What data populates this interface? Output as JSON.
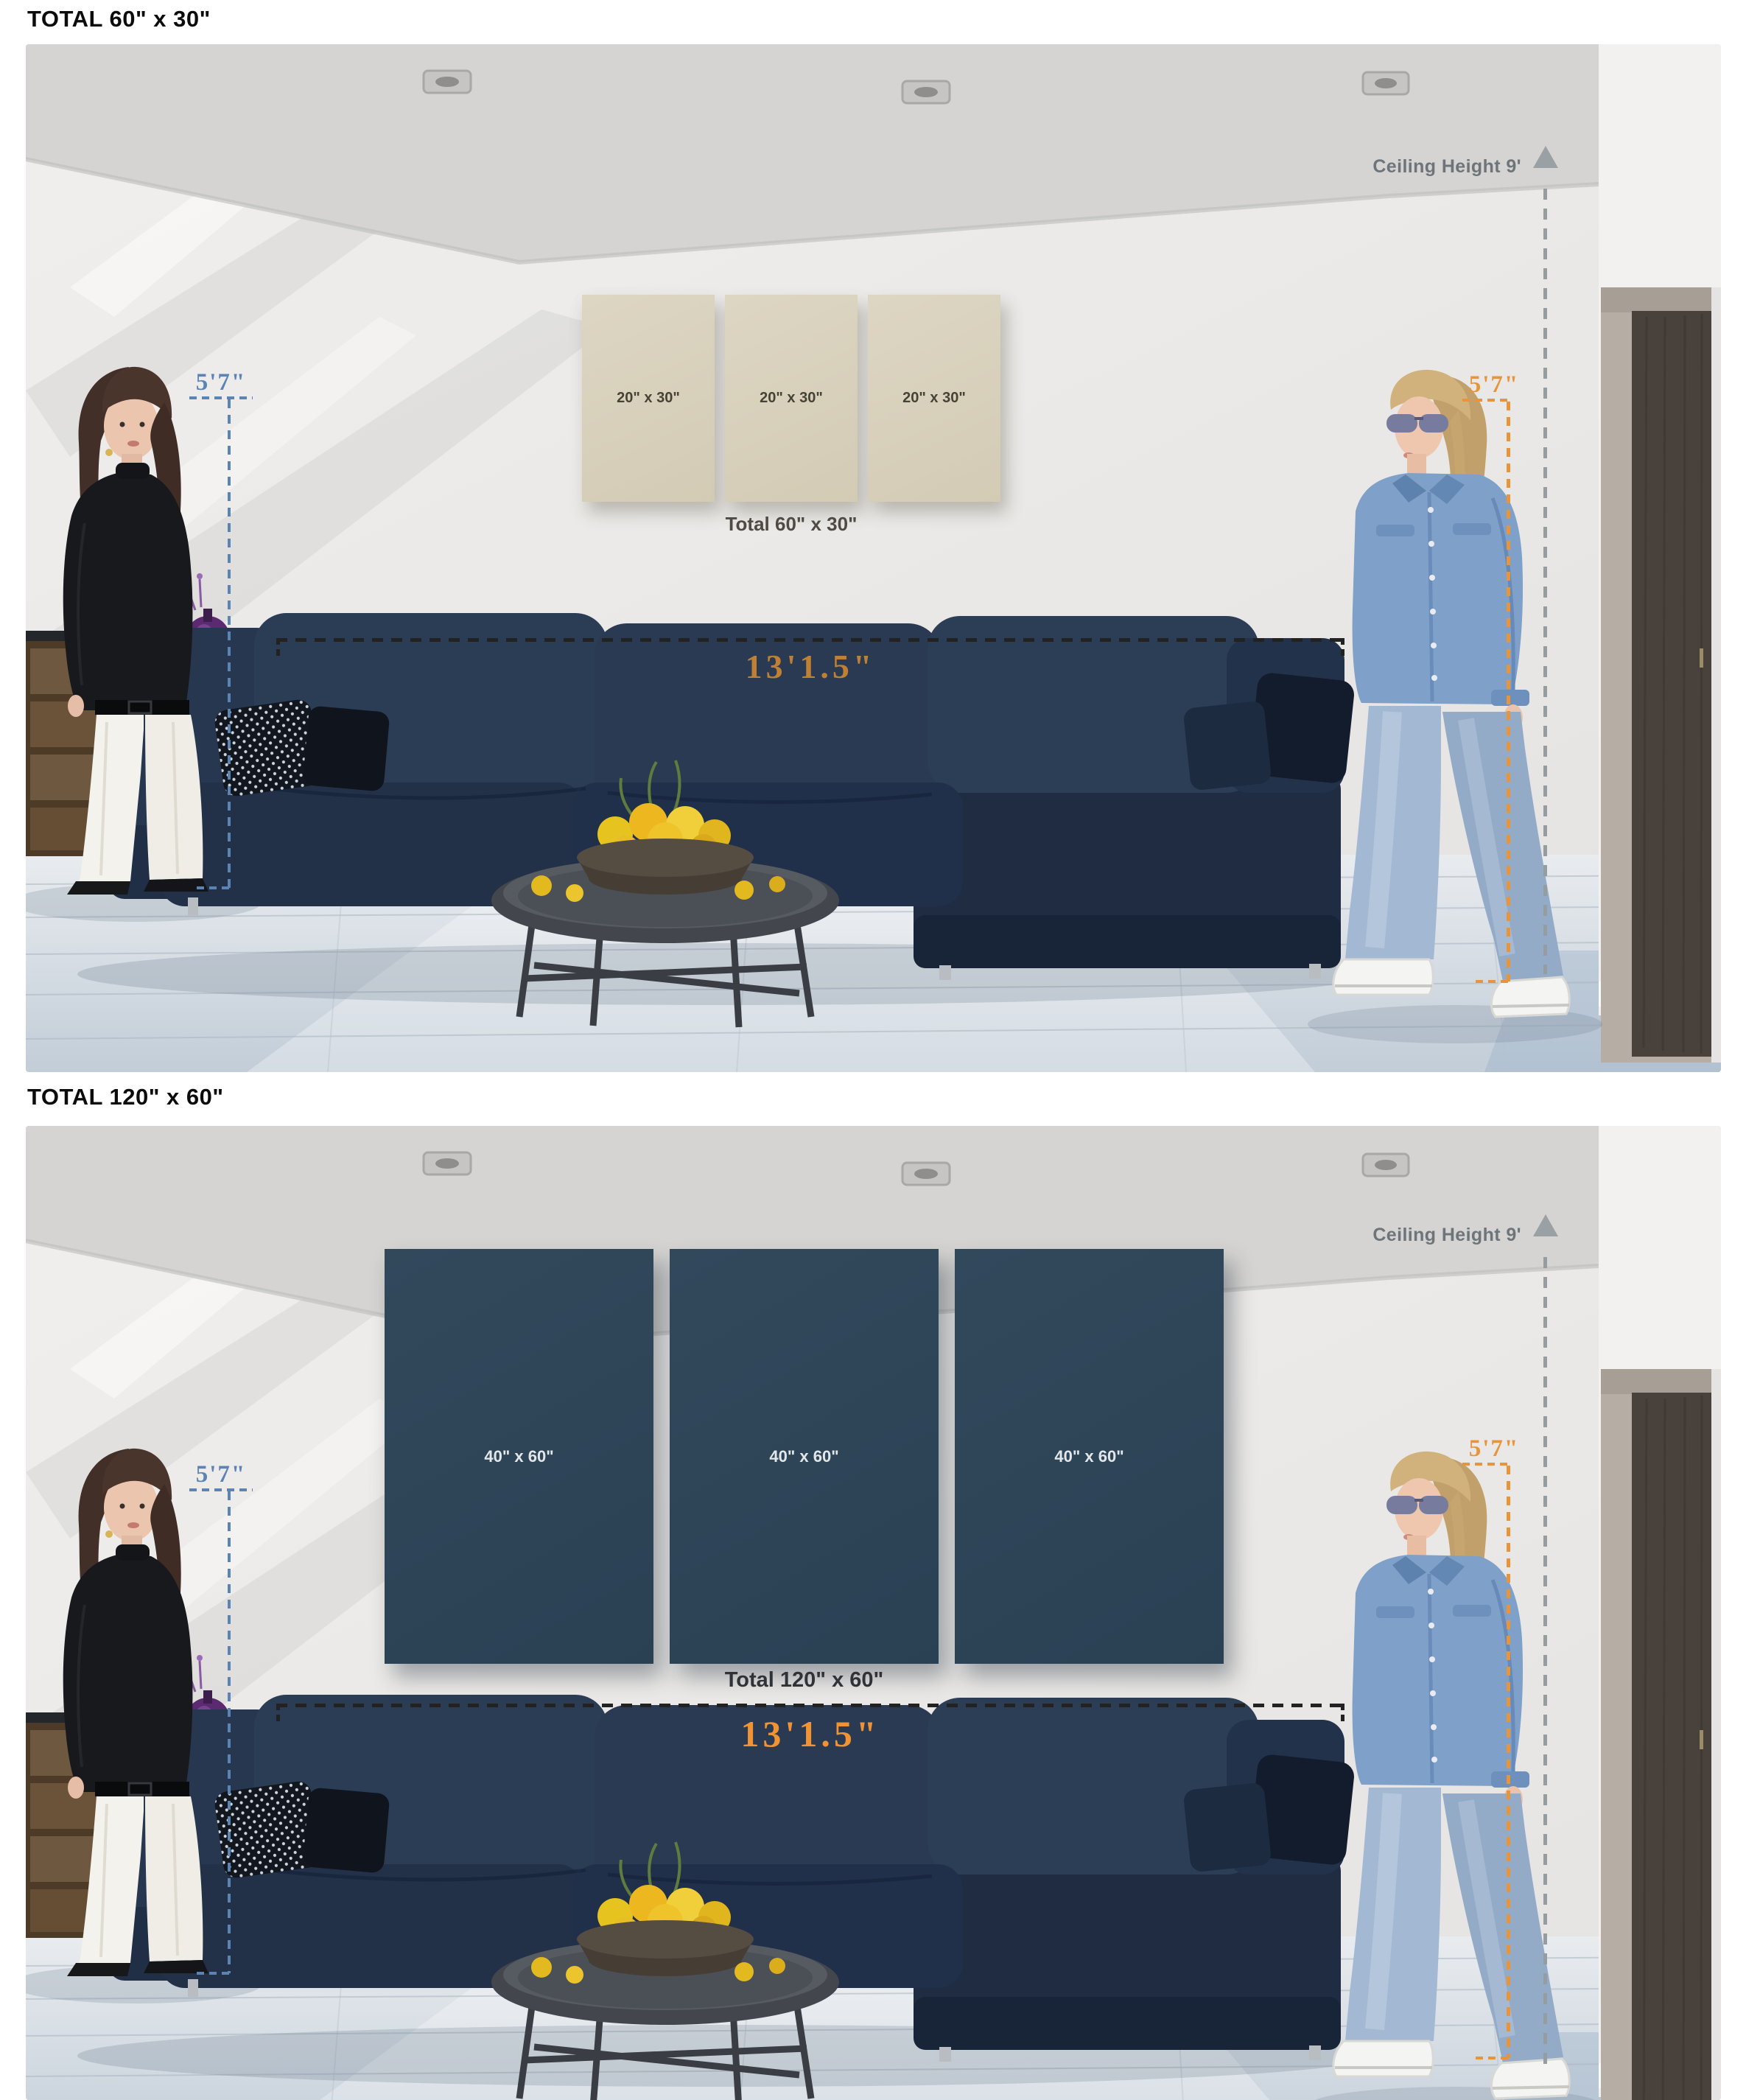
{
  "titles": {
    "top": "TOTAL 60\" x 30\"",
    "bottom": "TOTAL 120\" x 60\""
  },
  "scenes": [
    {
      "name": "room-with-60x30-canvas-set",
      "ceiling_label": "Ceiling Height 9'",
      "left_height": "5'7\"",
      "right_height": "5'7\"",
      "sofa_width": "13'1.5\"",
      "canvas": {
        "panels": [
          "20\" x 30\"",
          "20\" x 30\"",
          "20\" x 30\""
        ],
        "total": "Total 60\" x 30\""
      }
    },
    {
      "name": "room-with-120x60-canvas-set",
      "ceiling_label": "Ceiling Height 9'",
      "left_height": "5'7\"",
      "right_height": "5'7\"",
      "sofa_width": "13'1.5\"",
      "canvas": {
        "panels": [
          "40\" x 60\"",
          "40\" x 60\"",
          "40\" x 60\""
        ],
        "total": "Total 120\" x 60\""
      }
    }
  ],
  "colors": {
    "title": "#0c0c0c",
    "wall": "#ebe9e7",
    "ceiling": "#d5d4d2",
    "floor": "#cdd6df",
    "sofa_navy": "#2a3a52",
    "canvas_beige": "#d7d0bb",
    "canvas_slate": "#2e4759",
    "door_wood": "#49413b",
    "annotation_blue": "#5b84b5",
    "annotation_orange": "#e8943a",
    "annotation_gray": "#8f979b",
    "measure_dash": "#222222",
    "measure_text_top": "#bf8034",
    "measure_text_bottom": "#f09334"
  }
}
